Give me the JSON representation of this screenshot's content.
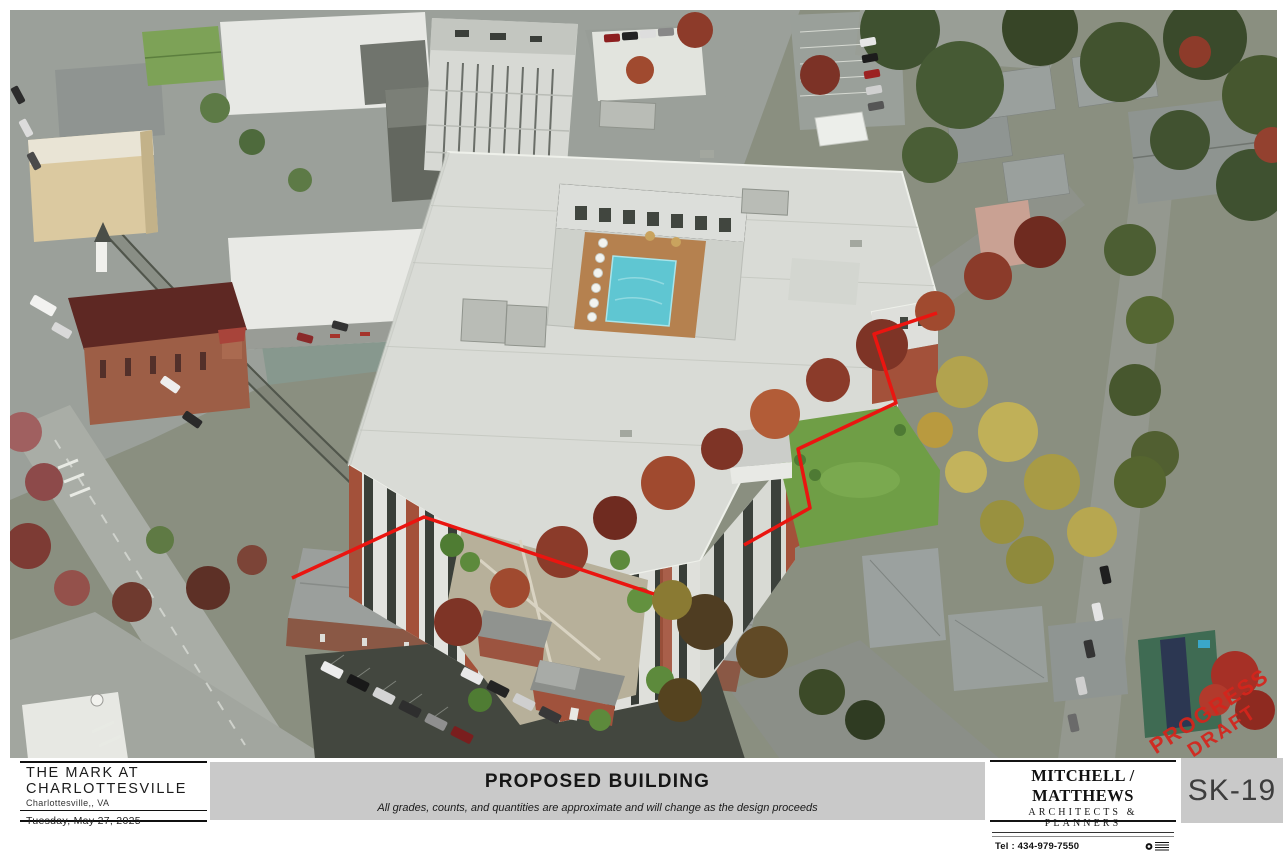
{
  "sheet": {
    "project": {
      "name_line1": "THE MARK AT",
      "name_line2": "CHARLOTTESVILLE",
      "location": "Charlottesville,, VA",
      "date": "Tuesday, May 27, 2025"
    },
    "drawing": {
      "title": "PROPOSED BUILDING",
      "disclaimer": "All grades, counts, and quantities are approximate and will change as the design proceeds"
    },
    "firm": {
      "name": "MITCHELL / MATTHEWS",
      "tagline": "ARCHITECTS & PLANNERS",
      "phone": "Tel : 434-979-7550"
    },
    "sheet_number": "SK-19",
    "stamp": {
      "line1": "PROGRESS",
      "line2": "DRAFT"
    }
  },
  "colors": {
    "panel_gray": "#c9c9c9",
    "stamp_red": "#d5251c",
    "property_line_red": "#ea1510",
    "pool_blue": "#5fc6d2",
    "brick_red": "#a3513a",
    "lawn_green": "#6f9e46"
  }
}
